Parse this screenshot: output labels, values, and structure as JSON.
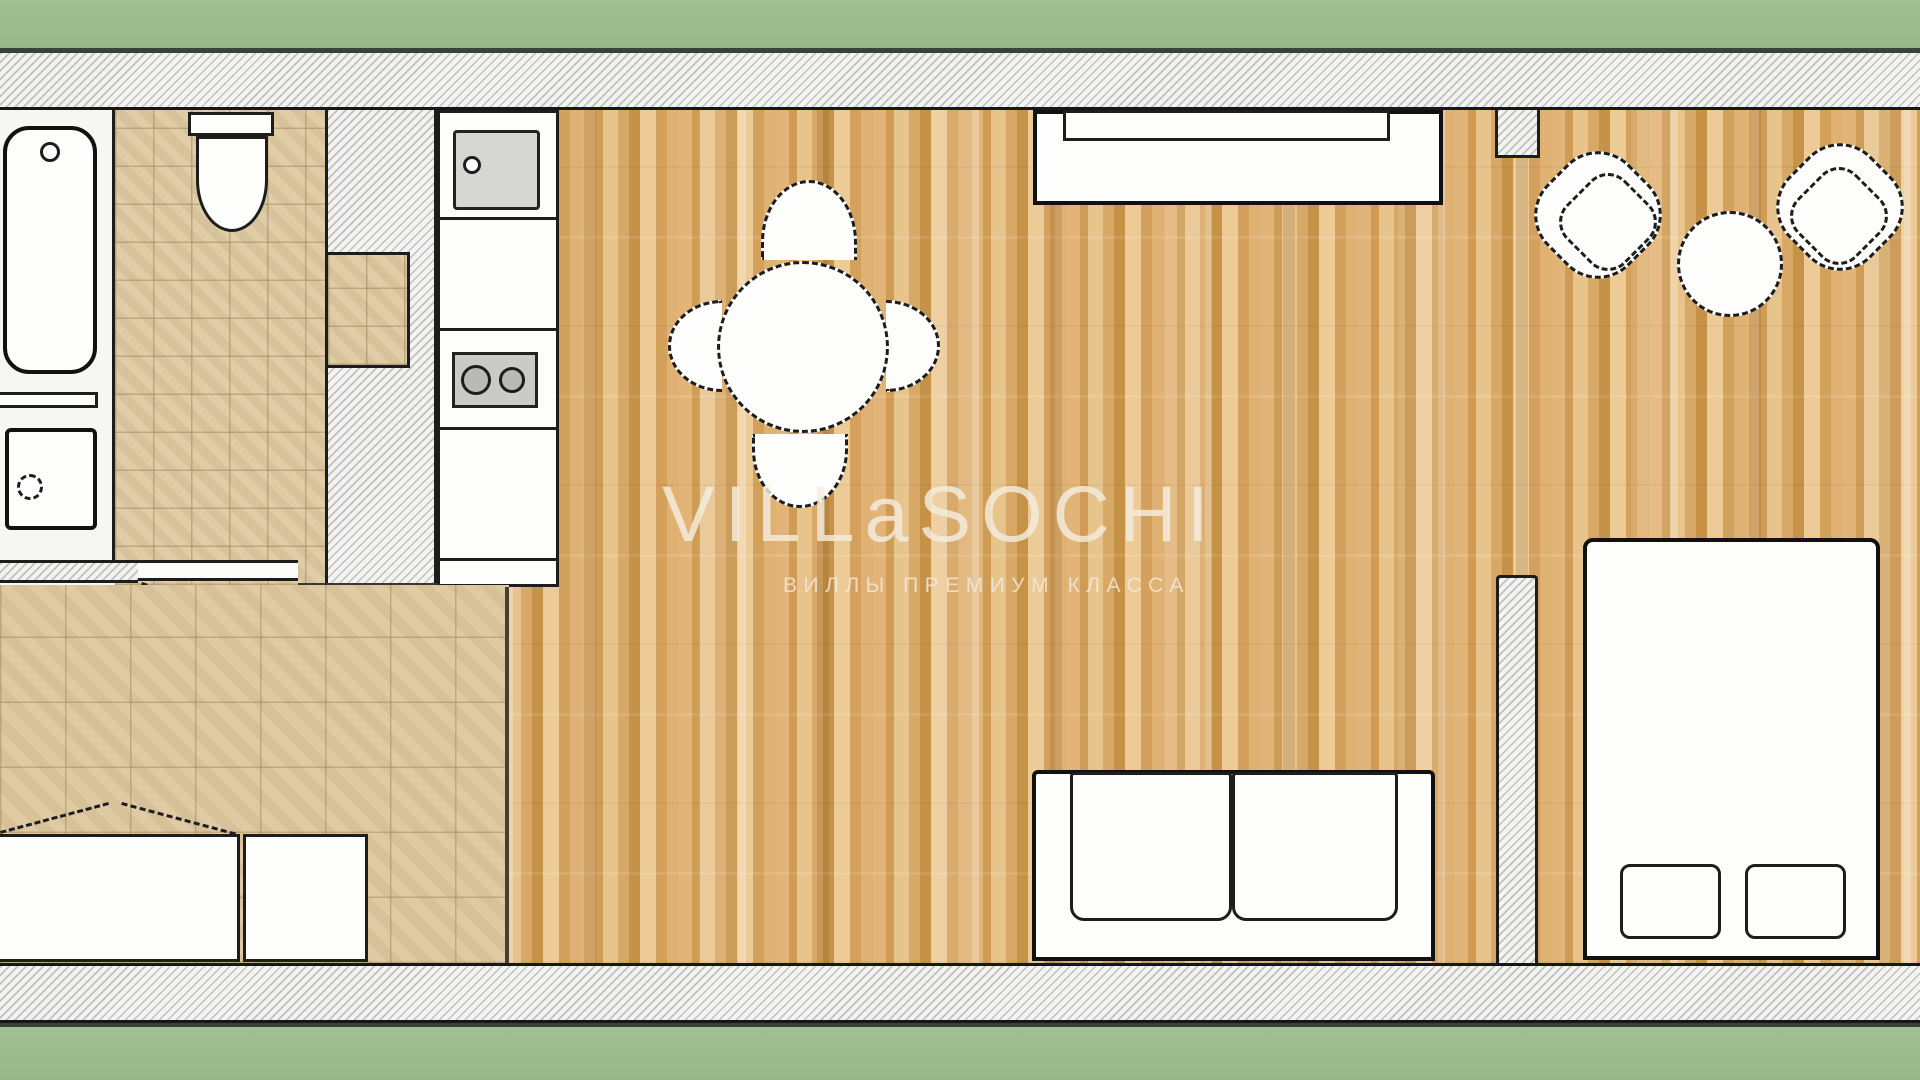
{
  "watermark": {
    "title": "VILLaSOCHI",
    "subtitle": "ВИЛЛЫ ПРЕМИУМ КЛАССА"
  },
  "palette": {
    "border_green": "#9dbb8e",
    "frame_line": "#3a4136",
    "wall_fill": "#f3f3f1",
    "wall_hatch_line": "#969694",
    "outline_black": "#1d1d1d",
    "wood_floor_base": "#d9a765",
    "wood_floor_light": "#eccb97",
    "wood_floor_dark": "#c69247",
    "tile_floor_base": "#decaa2",
    "tile_grid_line": "#8c7341",
    "fixture_white": "#fdfdfc",
    "appliance_gray": "#d6d6d4",
    "watermark_color": "#f4eddf"
  }
}
